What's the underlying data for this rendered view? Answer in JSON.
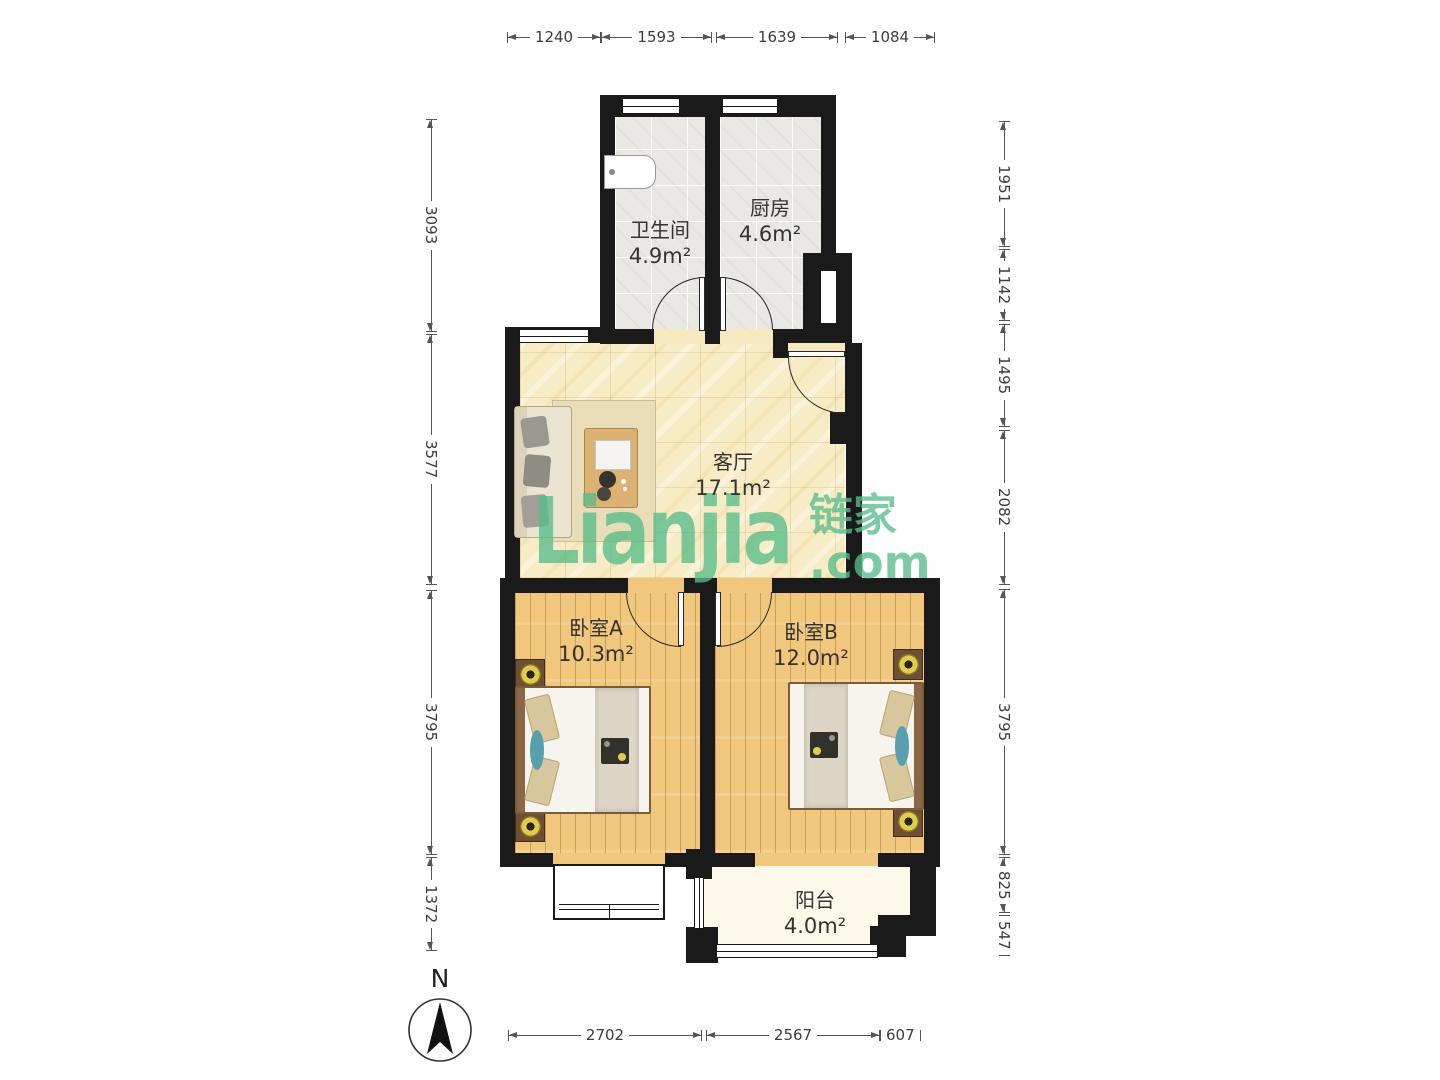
{
  "watermark": {
    "wordmark": "Lianjia",
    "cjk": "链家",
    "tld": ".com"
  },
  "compass": {
    "label": "N"
  },
  "rooms": [
    {
      "id": "bathroom",
      "name": "卫生间",
      "area": "4.9m²"
    },
    {
      "id": "kitchen",
      "name": "厨房",
      "area": "4.6m²"
    },
    {
      "id": "living",
      "name": "客厅",
      "area": "17.1m²"
    },
    {
      "id": "bedroomA",
      "name": "卧室A",
      "area": "10.3m²"
    },
    {
      "id": "bedroomB",
      "name": "卧室B",
      "area": "12.0m²"
    },
    {
      "id": "balcony",
      "name": "阳台",
      "area": "4.0m²"
    }
  ],
  "dimensions": {
    "top": [
      "1240",
      "1593",
      "1639",
      "1084"
    ],
    "left": [
      "3093",
      "3577",
      "3795",
      "1372"
    ],
    "right": [
      "1951",
      "1142",
      "1495",
      "2082",
      "3795",
      "825",
      "547"
    ],
    "bottom": [
      "2702",
      "2567",
      "607"
    ]
  },
  "colors": {
    "wall": "#1a1a1a",
    "watermark_green": "#58bd8b",
    "living_floor": "#f8ecc6",
    "wood_floor": "#f1c77e",
    "tile_floor": "#eae8e4",
    "balcony_floor": "#fcf9ea",
    "lamp_yellow": "#e2cd4b"
  }
}
